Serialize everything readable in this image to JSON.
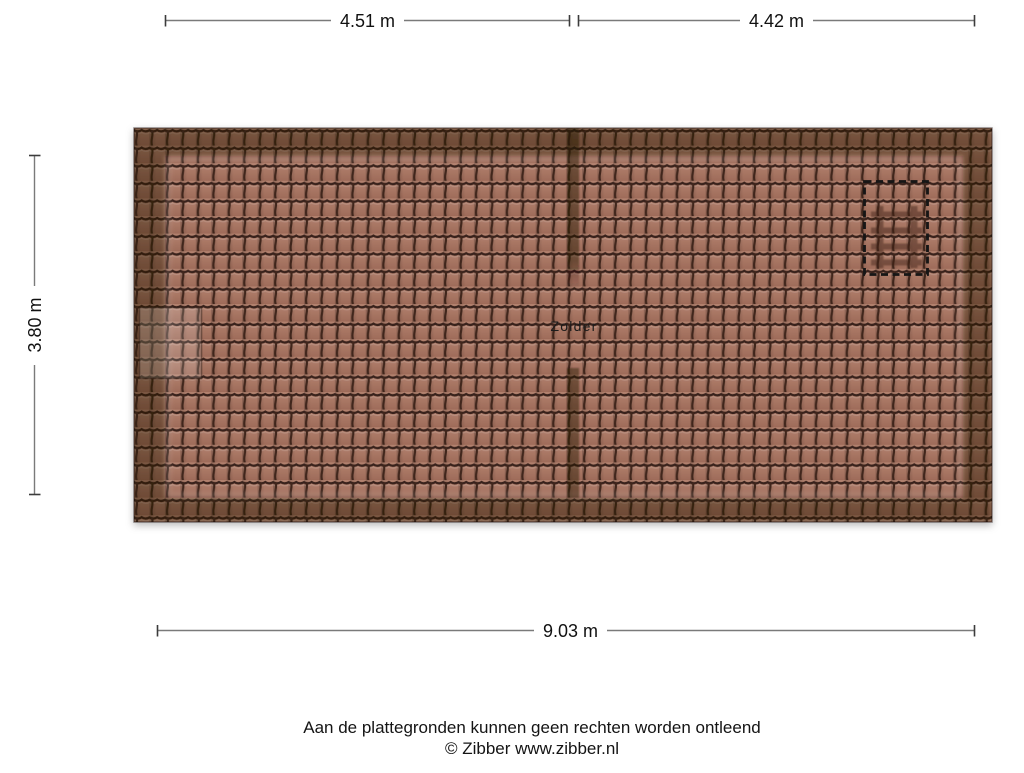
{
  "page": {
    "background_color": "#ffffff"
  },
  "floorplan": {
    "room_label": "Zolder",
    "dimensions": {
      "top_left": "4.51 m",
      "top_right": "4.42 m",
      "left": "3.80 m",
      "bottom": "9.03 m"
    },
    "features": {
      "roof_hatch": "dashed rectangle outline on right roof slope",
      "loft_ladder": "ladder seen through roof inside hatch outline",
      "ridge_wall": "dark interior wall line through roof centre with doorway gap",
      "side_window": "light rectangle on left roof edge"
    },
    "colors": {
      "tile_light": "#b3826f",
      "tile_dark": "#9e6b59",
      "tile_outline": "#38211a",
      "tile_joint": "#41271d",
      "eaves_overlay": "rgba(38,19,13,0.40)",
      "wall_overlay": "rgba(35,17,11,0.45)",
      "hatch_outline": "#121212",
      "ladder": "#3c2418",
      "dimension_line": "#7a7a7a",
      "dimension_tick": "#3c3c3c",
      "text": "#111111"
    }
  },
  "footer": {
    "disclaimer": "Aan de plattegronden kunnen geen rechten worden ontleend",
    "credit": "© Zibber www.zibber.nl"
  }
}
